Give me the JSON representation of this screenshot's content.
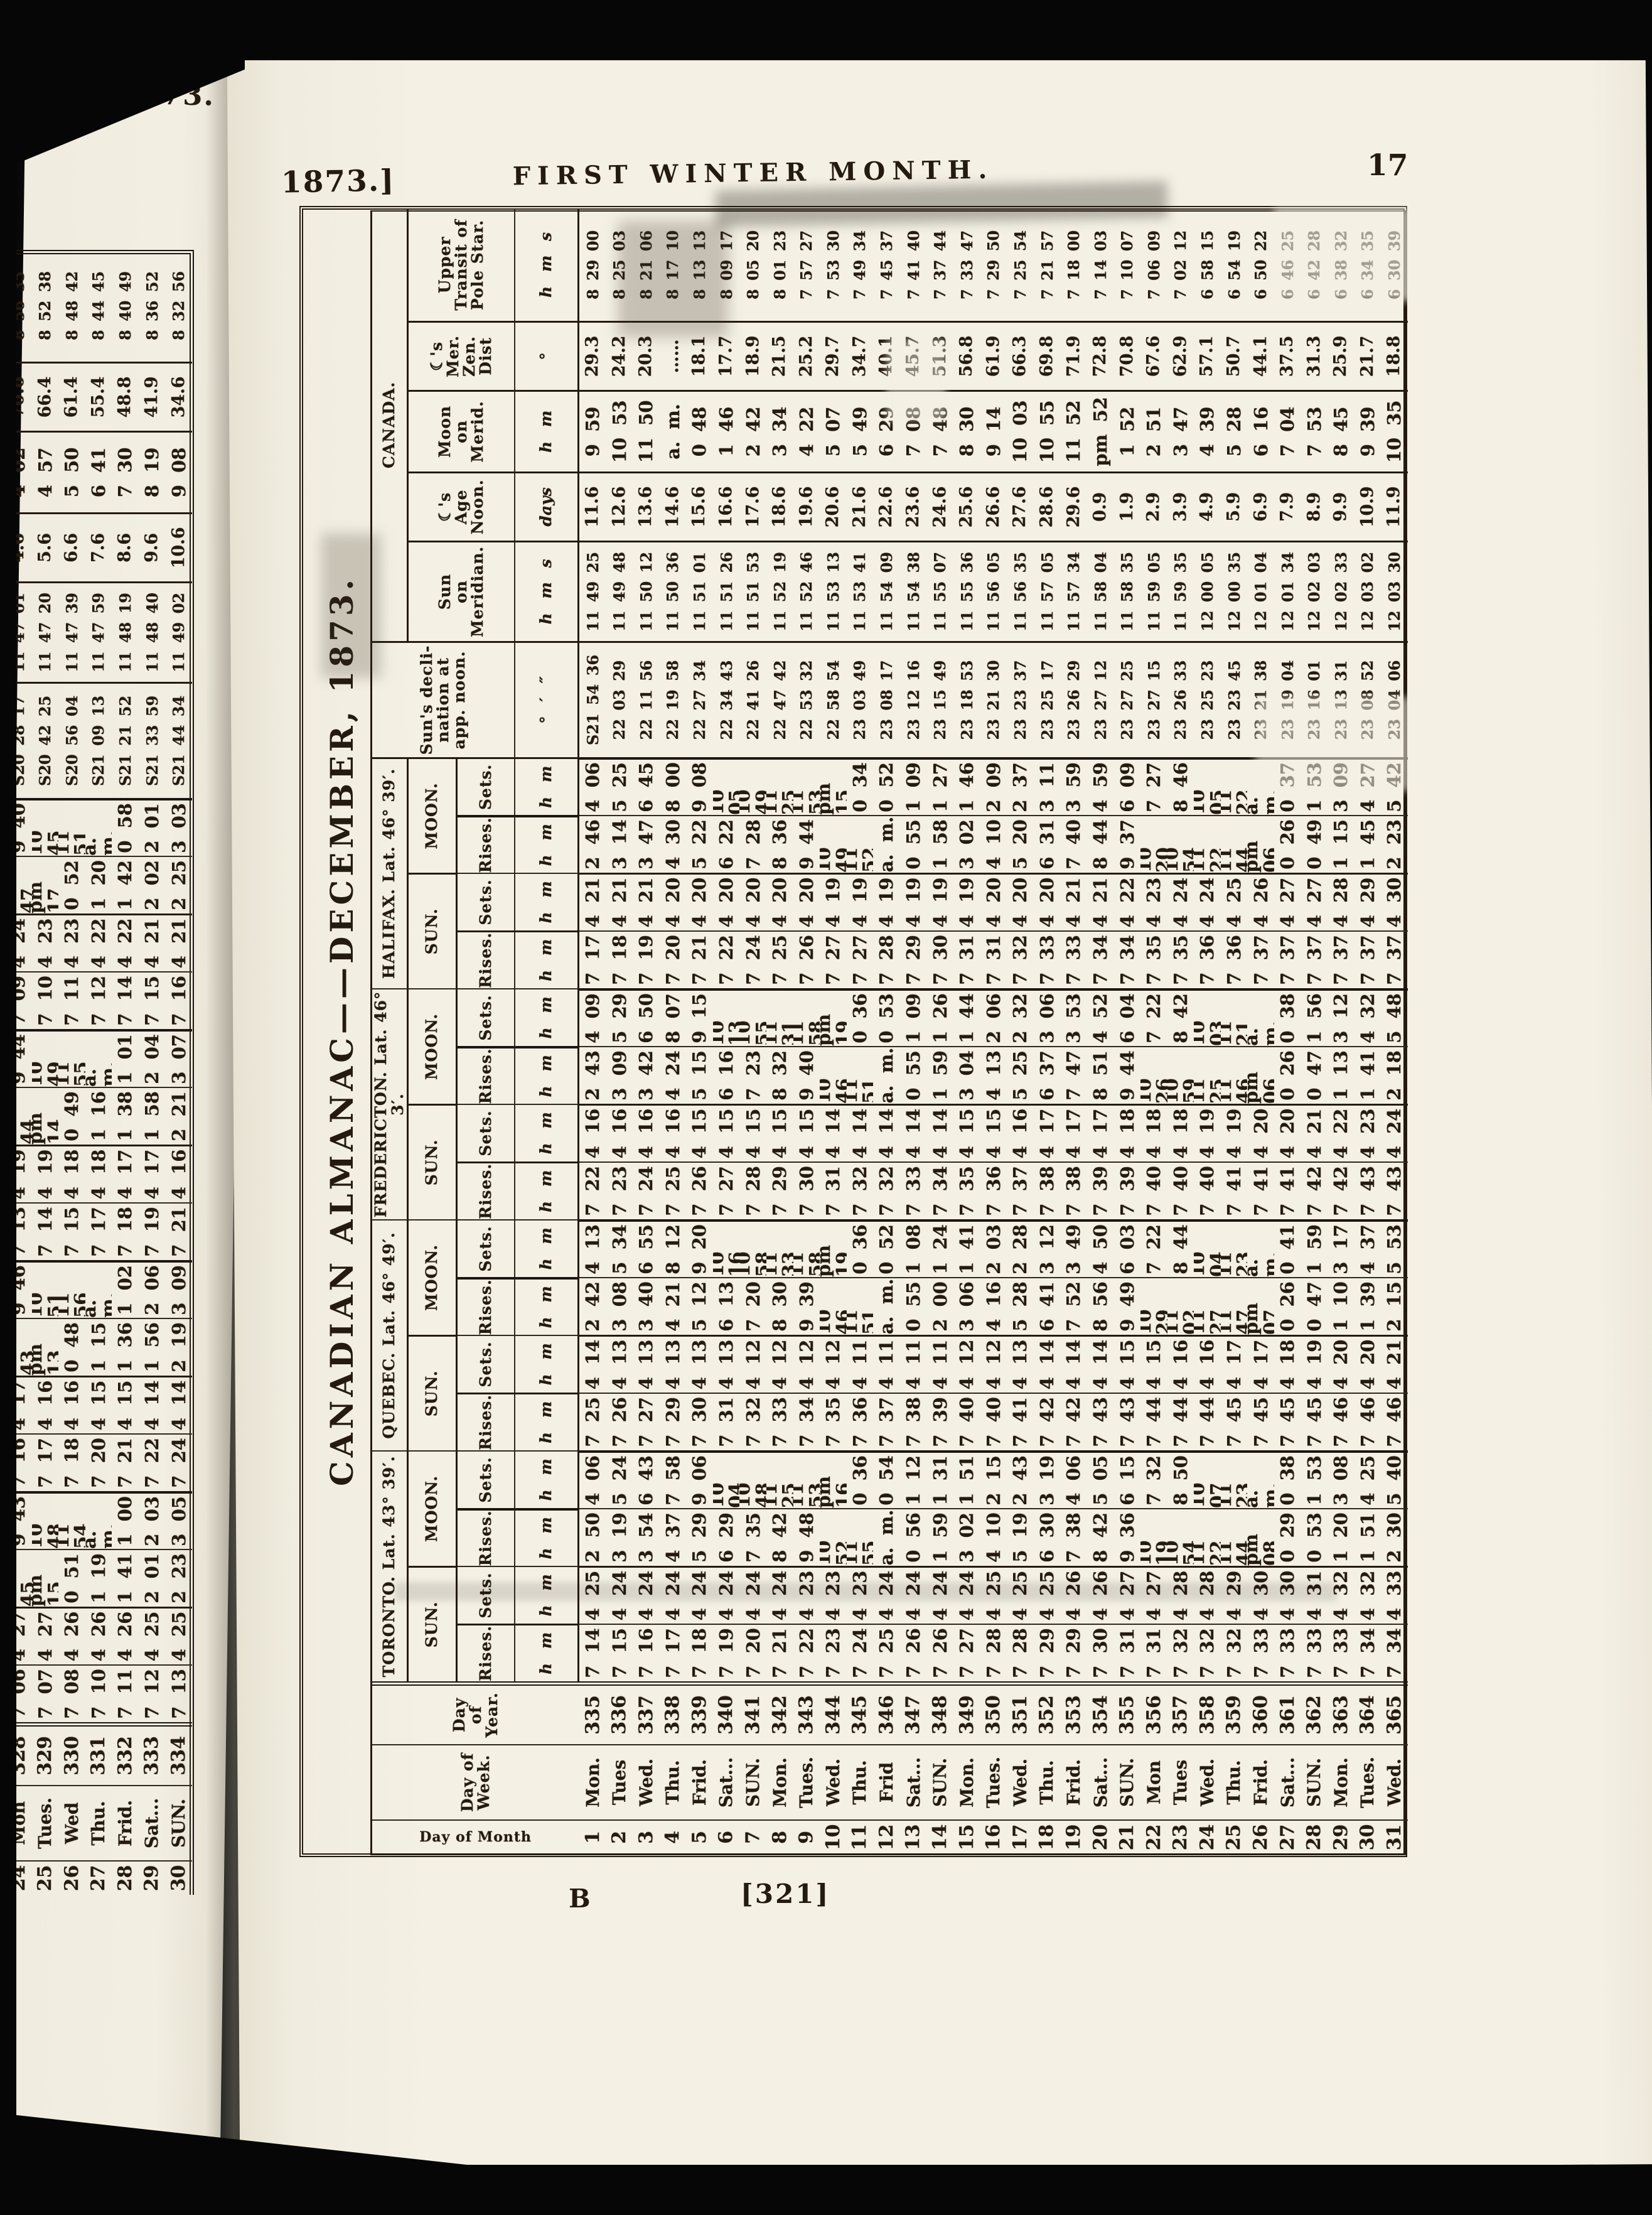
{
  "page": {
    "running_head_left": "1873.]",
    "running_head_center": "FIRST WINTER MONTH.",
    "page_number": "17",
    "signature": "B",
    "page_ref": "[321]",
    "prev_page_head": "[1873."
  },
  "title_rotated": "CANADIAN ALMANAC——DECEMBER, 1873.",
  "headers": {
    "day_of_month": "Day of Month",
    "day_of_week": "Day of\nWeek.",
    "day_of_year": "Day of\nYear.",
    "cities": [
      {
        "name": "TORONTO.",
        "lat": "Lat. 43° 39′."
      },
      {
        "name": "QUEBEC.",
        "lat": "Lat. 46° 49′."
      },
      {
        "name": "FREDERICTON.",
        "lat": "Lat. 46° 3′."
      },
      {
        "name": "HALIFAX.",
        "lat": "Lat. 46° 39′."
      }
    ],
    "sun": "SUN.",
    "moon": "MOON.",
    "rises": "Rises.",
    "sets": "Sets.",
    "hm": "h   m",
    "decl": "Sun's decli-\nnation at\napp. noon.",
    "decl_units": "°   ′   ″",
    "canada": "CANADA.",
    "canada_cols": [
      {
        "lines": "Sun\non\nMeridian.",
        "units": "h   m   s"
      },
      {
        "lines": "☾'s\nAge\nNoon.",
        "units": "days"
      },
      {
        "lines": "Moon\non\nMerid.",
        "units": "h   m"
      },
      {
        "lines": "☾'s\nMer.\nZen.\nDist",
        "units": "°"
      },
      {
        "lines": "Upper\nTransit of\nPole Star.",
        "units": "h   m   s"
      }
    ]
  },
  "column_keys": [
    "day_of_month",
    "day_of_week",
    "day_of_year",
    "toronto_sun_rises",
    "toronto_sun_sets",
    "toronto_moon_rises",
    "toronto_moon_sets",
    "quebec_sun_rises",
    "quebec_sun_sets",
    "quebec_moon_rises",
    "quebec_moon_sets",
    "fredericton_sun_rises",
    "fredericton_sun_sets",
    "fredericton_moon_rises",
    "fredericton_moon_sets",
    "halifax_sun_rises",
    "halifax_sun_sets",
    "halifax_moon_rises",
    "halifax_moon_sets",
    "sun_declination",
    "sun_on_meridian",
    "moon_age",
    "moon_on_meridian",
    "moon_zenith_dist",
    "upper_transit_pole_star"
  ],
  "rows": [
    [
      "1",
      "Mon.",
      "335",
      "7 14",
      "4 25",
      "2 50",
      "4 06",
      "7 25",
      "4 14",
      "2 42",
      "4 13",
      "7 22",
      "4 16",
      "2 43",
      "4 09",
      "7 17",
      "4 21",
      "2 46",
      "4 06",
      "S21 54 36",
      "11 49 25",
      "11.6",
      "9 59",
      "29.3",
      "8 29 00"
    ],
    [
      "2",
      "Tues",
      "336",
      "7 15",
      "4 24",
      "3 19",
      "5 24",
      "7 26",
      "4 13",
      "3 08",
      "5 34",
      "7 23",
      "4 16",
      "3 09",
      "5 29",
      "7 18",
      "4 21",
      "3 14",
      "5 25",
      "22 03 29",
      "11 49 48",
      "12.6",
      "10 53",
      "24.2",
      "8 25 03"
    ],
    [
      "3",
      "Wed.",
      "337",
      "7 16",
      "4 24",
      "3 54",
      "6 43",
      "7 27",
      "4 13",
      "3 40",
      "6 55",
      "7 24",
      "4 16",
      "3 42",
      "6 50",
      "7 19",
      "4 21",
      "3 47",
      "6 45",
      "22 11 56",
      "11 50 12",
      "13.6",
      "11 50",
      "20.3",
      "8 21 06"
    ],
    [
      "4",
      "Thu.",
      "338",
      "7 17",
      "4 24",
      "4 37",
      "7 58",
      "7 29",
      "4 13",
      "4 21",
      "8 12",
      "7 25",
      "4 16",
      "4 24",
      "8 07",
      "7 20",
      "4 20",
      "4 30",
      "8 00",
      "22 19 58",
      "11 50 36",
      "14.6",
      "a. m.",
      "……",
      "8 17 10"
    ],
    [
      "5",
      "Frid.",
      "339",
      "7 18",
      "4 24",
      "5 29",
      "9 06",
      "7 30",
      "4 13",
      "5 12",
      "9 20",
      "7 26",
      "4 15",
      "5 15",
      "9 15",
      "7 21",
      "4 20",
      "5 22",
      "9 08",
      "22 27 34",
      "11 51 01",
      "15.6",
      "0 48",
      "18.1",
      "8 13 13"
    ],
    [
      "6",
      "Sat...",
      "340",
      "7 19",
      "4 24",
      "6 29",
      "10 04",
      "7 31",
      "4 13",
      "6 13",
      "10 16",
      "7 27",
      "4 15",
      "6 16",
      "10 13",
      "7 22",
      "4 20",
      "6 22",
      "10 05",
      "22 34 43",
      "11 51 26",
      "16.6",
      "1 46",
      "17.7",
      "8 09 17"
    ],
    [
      "7",
      "SUN.",
      "341",
      "7 20",
      "4 24",
      "7 35",
      "10 48",
      "7 32",
      "4 12",
      "7 20",
      "10 58",
      "7 28",
      "4 15",
      "7 23",
      "10 55",
      "7 24",
      "4 20",
      "7 28",
      "10 49",
      "22 41 26",
      "11 51 53",
      "17.6",
      "2 42",
      "18.9",
      "8 05 20"
    ],
    [
      "8",
      "Mon.",
      "342",
      "7 21",
      "4 24",
      "8 42",
      "11 25",
      "7 33",
      "4 12",
      "8 30",
      "11 33",
      "7 29",
      "4 15",
      "8 32",
      "11 31",
      "7 25",
      "4 20",
      "8 36",
      "11 25",
      "22 47 42",
      "11 52 19",
      "18.6",
      "3 34",
      "21.5",
      "8 01 23"
    ],
    [
      "9",
      "Tues.",
      "343",
      "7 22",
      "4 23",
      "9 48",
      "11 53",
      "7 34",
      "4 12",
      "9 39",
      "11 58",
      "7 30",
      "4 15",
      "9 40",
      "11 58",
      "7 26",
      "4 20",
      "9 44",
      "11 53",
      "22 53 32",
      "11 52 46",
      "19.6",
      "4 22",
      "25.2",
      "7 57 27"
    ],
    [
      "10",
      "Wed.",
      "344",
      "7 23",
      "4 23",
      "10 52",
      "pm 16",
      "7 35",
      "4 12",
      "10 46",
      "pm 19",
      "7 31",
      "4 14",
      "10 46",
      "pm 19",
      "7 27",
      "4 19",
      "10 49",
      "pm 15",
      "22 58 54",
      "11 53 13",
      "20.6",
      "5 07",
      "29.7",
      "7 53 30"
    ],
    [
      "11",
      "Thu.",
      "345",
      "7 24",
      "4 23",
      "11 55",
      "0 36",
      "7 36",
      "4 11",
      "11 51",
      "0 36",
      "7 32",
      "4 14",
      "11 51",
      "0 36",
      "7 27",
      "4 19",
      "11 52",
      "0 34",
      "23 03 49",
      "11 53 41",
      "21.6",
      "5 49",
      "34.7",
      "7 49 34"
    ],
    [
      "12",
      "Frid",
      "346",
      "7 25",
      "4 24",
      "a. m.",
      "0 54",
      "7 37",
      "4 11",
      "a. m.",
      "0 52",
      "7 32",
      "4 14",
      "a. m.",
      "0 53",
      "7 28",
      "4 19",
      "a. m.",
      "0 52",
      "23 08 17",
      "11 54 09",
      "22.6",
      "6 29",
      "40.1",
      "7 45 37"
    ],
    [
      "13",
      "Sat...",
      "347",
      "7 26",
      "4 24",
      "0 56",
      "1 12",
      "7 38",
      "4 11",
      "0 55",
      "1 08",
      "7 33",
      "4 14",
      "0 55",
      "1 09",
      "7 29",
      "4 19",
      "0 55",
      "1 09",
      "23 12 16",
      "11 54 38",
      "23.6",
      "7 08",
      "45.7",
      "7 41 40"
    ],
    [
      "14",
      "SUN.",
      "348",
      "7 26",
      "4 24",
      "1 59",
      "1 31",
      "7 39",
      "4 11",
      "2 00",
      "1 24",
      "7 34",
      "4 14",
      "1 59",
      "1 26",
      "7 30",
      "4 19",
      "1 58",
      "1 27",
      "23 15 49",
      "11 55 07",
      "24.6",
      "7 48",
      "51.3",
      "7 37 44"
    ],
    [
      "15",
      "Mon.",
      "349",
      "7 27",
      "4 24",
      "3 02",
      "1 51",
      "7 40",
      "4 12",
      "3 06",
      "1 41",
      "7 35",
      "4 15",
      "3 04",
      "1 44",
      "7 31",
      "4 19",
      "3 02",
      "1 46",
      "23 18 53",
      "11 55 36",
      "25.6",
      "8 30",
      "56.8",
      "7 33 47"
    ],
    [
      "16",
      "Tues.",
      "350",
      "7 28",
      "4 25",
      "4 10",
      "2 15",
      "7 40",
      "4 12",
      "4 16",
      "2 03",
      "7 36",
      "4 15",
      "4 13",
      "2 06",
      "7 31",
      "4 20",
      "4 10",
      "2 09",
      "23 21 30",
      "11 56 05",
      "26.6",
      "9 14",
      "61.9",
      "7 29 50"
    ],
    [
      "17",
      "Wed.",
      "351",
      "7 28",
      "4 25",
      "5 19",
      "2 43",
      "7 41",
      "4 13",
      "5 28",
      "2 28",
      "7 37",
      "4 16",
      "5 25",
      "2 32",
      "7 32",
      "4 20",
      "5 20",
      "2 37",
      "23 23 37",
      "11 56 35",
      "27.6",
      "10 03",
      "66.3",
      "7 25 54"
    ],
    [
      "18",
      "Thu.",
      "352",
      "7 29",
      "4 25",
      "6 30",
      "3 19",
      "7 42",
      "4 14",
      "6 41",
      "3 12",
      "7 38",
      "4 17",
      "6 37",
      "3 06",
      "7 33",
      "4 20",
      "6 31",
      "3 11",
      "23 25 17",
      "11 57 05",
      "28.6",
      "10 55",
      "69.8",
      "7 21 57"
    ],
    [
      "19",
      "Frid.",
      "353",
      "7 29",
      "4 26",
      "7 38",
      "4 06",
      "7 42",
      "4 14",
      "7 52",
      "3 49",
      "7 38",
      "4 17",
      "7 47",
      "3 53",
      "7 33",
      "4 21",
      "7 40",
      "3 59",
      "23 26 29",
      "11 57 34",
      "29.6",
      "11 52",
      "71.9",
      "7 18 00"
    ],
    [
      "20",
      "Sat...",
      "354",
      "7 30",
      "4 26",
      "8 42",
      "5 05",
      "7 43",
      "4 14",
      "8 56",
      "4 50",
      "7 39",
      "4 17",
      "8 51",
      "4 52",
      "7 34",
      "4 21",
      "8 44",
      "4 59",
      "23 27 12",
      "11 58 04",
      "0.9",
      "pm 52",
      "72.8",
      "7 14 03"
    ],
    [
      "21",
      "SUN.",
      "355",
      "7 31",
      "4 27",
      "9 36",
      "6 15",
      "7 43",
      "4 15",
      "9 49",
      "6 03",
      "7 39",
      "4 18",
      "9 44",
      "6 04",
      "7 34",
      "4 22",
      "9 37",
      "6 09",
      "23 27 25",
      "11 58 35",
      "1.9",
      "1 52",
      "70.8",
      "7 10 07"
    ],
    [
      "22",
      "Mon",
      "356",
      "7 31",
      "4 27",
      "10 19",
      "7 32",
      "7 44",
      "4 15",
      "10 29",
      "7 22",
      "7 40",
      "4 18",
      "10 26",
      "7 22",
      "7 35",
      "4 23",
      "10 20",
      "7 27",
      "23 27 15",
      "11 59 05",
      "2.9",
      "2 51",
      "67.6",
      "7 06 09"
    ],
    [
      "23",
      "Tues",
      "357",
      "7 32",
      "4 28",
      "10 54",
      "8 50",
      "7 44",
      "4 16",
      "11 02",
      "8 44",
      "7 40",
      "4 18",
      "10 59",
      "8 42",
      "7 35",
      "4 24",
      "10 54",
      "8 46",
      "23 26 33",
      "11 59 35",
      "3.9",
      "3 47",
      "62.9",
      "7 02 12"
    ],
    [
      "24",
      "Wed.",
      "358",
      "7 32",
      "4 28",
      "11 22",
      "10 07",
      "7 44",
      "4 16",
      "11 27",
      "10 04",
      "7 40",
      "4 19",
      "11 25",
      "10 03",
      "7 36",
      "4 24",
      "11 22",
      "10 05",
      "23 25 23",
      "12 00 05",
      "4.9",
      "4 39",
      "57.1",
      "6 58 15"
    ],
    [
      "25",
      "Thu.",
      "359",
      "7 32",
      "4 29",
      "11 44",
      "11 23",
      "7 45",
      "4 17",
      "11 47",
      "11 23",
      "7 41",
      "4 19",
      "11 46",
      "11 21",
      "7 36",
      "4 25",
      "11 44",
      "11 22",
      "23 23 45",
      "12 00 35",
      "5.9",
      "5 28",
      "50.7",
      "6 54 19"
    ],
    [
      "26",
      "Frid.",
      "360",
      "7 33",
      "4 30",
      "pm 08",
      "a. m.",
      "7 45",
      "4 17",
      "pm 07",
      "a. m.",
      "7 41",
      "4 20",
      "pm 06",
      "a. m.",
      "7 37",
      "4 26",
      "pm 06",
      "a. m.",
      "23 21 38",
      "12 01 04",
      "6.9",
      "6 16",
      "44.1",
      "6 50 22"
    ],
    [
      "27",
      "Sat...",
      "361",
      "7 33",
      "4 30",
      "0 29",
      "0 38",
      "7 45",
      "4 18",
      "0 26",
      "0 41",
      "7 41",
      "4 20",
      "0 26",
      "0 38",
      "7 37",
      "4 27",
      "0 26",
      "0 37",
      "23 19 04",
      "12 01 34",
      "7.9",
      "7 04",
      "37.5",
      "6 46 25"
    ],
    [
      "28",
      "SUN.",
      "362",
      "7 33",
      "4 31",
      "0 53",
      "1 53",
      "7 45",
      "4 19",
      "0 47",
      "1 59",
      "7 42",
      "4 21",
      "0 47",
      "1 56",
      "7 37",
      "4 27",
      "0 49",
      "1 53",
      "23 16 01",
      "12 02 03",
      "8.9",
      "7 53",
      "31.3",
      "6 42 28"
    ],
    [
      "29",
      "Mon.",
      "363",
      "7 33",
      "4 32",
      "1 20",
      "3 08",
      "7 46",
      "4 20",
      "1 10",
      "3 17",
      "7 42",
      "4 22",
      "1 13",
      "3 12",
      "7 37",
      "4 28",
      "1 15",
      "3 09",
      "23 13 31",
      "12 02 33",
      "9.9",
      "8 45",
      "25.9",
      "6 38 32"
    ],
    [
      "30",
      "Tues.",
      "364",
      "7 34",
      "4 32",
      "1 51",
      "4 25",
      "7 46",
      "4 20",
      "1 39",
      "4 37",
      "7 43",
      "4 23",
      "1 41",
      "4 32",
      "7 37",
      "4 29",
      "1 45",
      "4 27",
      "23 08 52",
      "12 03 02",
      "10.9",
      "9 39",
      "21.7",
      "6 34 35"
    ],
    [
      "31",
      "Wed.",
      "365",
      "7 34",
      "4 33",
      "2 30",
      "5 40",
      "7 46",
      "4 21",
      "2 15",
      "5 53",
      "7 43",
      "4 24",
      "2 18",
      "5 48",
      "7 37",
      "4 30",
      "2 23",
      "5 42",
      "23 04 06",
      "12 03 30",
      "11.9",
      "10 35",
      "18.8",
      "6 30 39"
    ]
  ],
  "prev_page_rows": [
    [
      "24",
      "Mon",
      "328",
      "7 06",
      "4 27",
      "11 45",
      "9 43",
      "7 16",
      "4 17",
      "11 43",
      "9 46",
      "7 13",
      "4 19",
      "11 44",
      "9 44",
      "7 09",
      "4 24",
      "11 47",
      "9 40",
      "S20 28 17",
      "11 47 01",
      "4.6",
      "4 02",
      "70.6",
      "8 56 35"
    ],
    [
      "25",
      "Tues.",
      "329",
      "7 07",
      "4 27",
      "pm 15",
      "10 48",
      "7 17",
      "4 16",
      "pm 13",
      "10 51",
      "7 14",
      "4 19",
      "pm 14",
      "10 49",
      "7 10",
      "4 23",
      "pm 17",
      "10 45",
      "S20 42 25",
      "11 47 20",
      "5.6",
      "4 57",
      "66.4",
      "8 52 38"
    ],
    [
      "26",
      "Wed",
      "330",
      "7 08",
      "4 26",
      "0 51",
      "11 54",
      "7 18",
      "4 16",
      "0 48",
      "11 56",
      "7 15",
      "4 18",
      "0 49",
      "11 55",
      "7 11",
      "4 23",
      "0 52",
      "11 51",
      "S20 56 04",
      "11 47 39",
      "6.6",
      "5 50",
      "61.4",
      "8 48 42"
    ],
    [
      "27",
      "Thu.",
      "331",
      "7 10",
      "4 26",
      "1 19",
      "a. m.",
      "7 20",
      "4 15",
      "1 15",
      "a. m.",
      "7 17",
      "4 18",
      "1 16",
      "a. m.",
      "7 12",
      "4 22",
      "1 20",
      "a. m.",
      "S21 09 13",
      "11 47 59",
      "7.6",
      "6 41",
      "55.4",
      "8 44 45"
    ],
    [
      "28",
      "Frid.",
      "332",
      "7 11",
      "4 26",
      "1 41",
      "1 00",
      "7 21",
      "4 15",
      "1 36",
      "1 02",
      "7 18",
      "4 17",
      "1 38",
      "1 01",
      "7 14",
      "4 22",
      "1 42",
      "0 58",
      "S21 21 52",
      "11 48 19",
      "8.6",
      "7 30",
      "48.8",
      "8 40 49"
    ],
    [
      "29",
      "Sat...",
      "333",
      "7 12",
      "4 25",
      "2 01",
      "2 03",
      "7 22",
      "4 14",
      "1 56",
      "2 06",
      "7 19",
      "4 17",
      "1 58",
      "2 04",
      "7 15",
      "4 21",
      "2 02",
      "2 01",
      "S21 33 59",
      "11 48 40",
      "9.6",
      "8 19",
      "41.9",
      "8 36 52"
    ],
    [
      "30",
      "SUN.",
      "334",
      "7 13",
      "4 25",
      "2 23",
      "3 05",
      "7 24",
      "4 14",
      "2 19",
      "3 09",
      "7 21",
      "4 16",
      "2 21",
      "3 07",
      "7 16",
      "4 21",
      "2 25",
      "3 03",
      "S21 44 34",
      "11 49 02",
      "10.6",
      "9 08",
      "34.6",
      "8 32 56"
    ]
  ]
}
